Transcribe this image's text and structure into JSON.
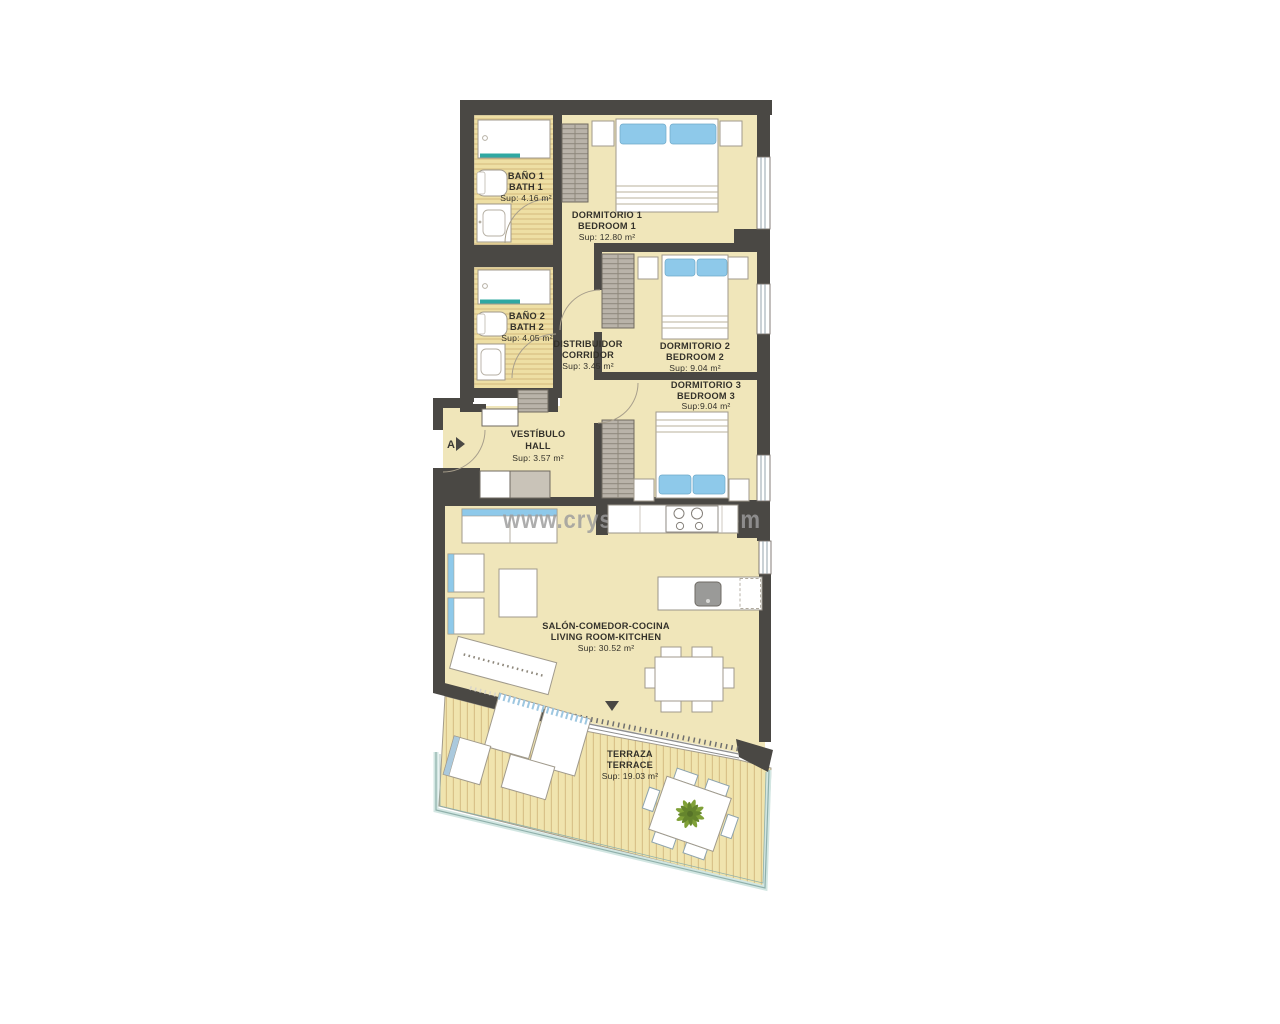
{
  "watermark": "www.crystalshore.com",
  "section_marker": {
    "label": "A"
  },
  "rooms": {
    "bathroom1": {
      "name_es": "BAÑO 1",
      "name_en": "BATH 1",
      "area": "Sup: 4.16 m²"
    },
    "bathroom2": {
      "name_es": "BAÑO 2",
      "name_en": "BATH 2",
      "area": "Sup: 4.05 m²"
    },
    "bedroom1": {
      "name_es": "DORMITORIO 1",
      "name_en": "BEDROOM 1",
      "area": "Sup: 12.80 m²"
    },
    "bedroom2": {
      "name_es": "DORMITORIO 2",
      "name_en": "BEDROOM 2",
      "area": "Sup: 9.04 m²"
    },
    "bedroom3": {
      "name_es": "DORMITORIO 3",
      "name_en": "BEDROOM 3",
      "area": "Sup:9.04 m²"
    },
    "corridor": {
      "name_es": "DISTRIBUIDOR",
      "name_en": "CORRIDOR",
      "area": "Sup: 3.45 m²"
    },
    "hall": {
      "name_es": "VESTÍBULO",
      "name_en": "HALL",
      "area": "Sup: 3.57 m²"
    },
    "living": {
      "name_es": "SALÓN-COMEDOR-COCINA",
      "name_en": "LIVING ROOM-KITCHEN",
      "area": "Sup: 30.52 m²"
    },
    "terrace": {
      "name_es": "TERRAZA",
      "name_en": "TERRACE",
      "area": "Sup: 19.03 m²"
    }
  },
  "colors": {
    "wall": "#4a4844",
    "floor": "#f0e6ba",
    "bath_floor": "#eedfa4",
    "deck_floor": "#f0e4ae",
    "accent_blue": "#8ec9ea",
    "tub_teal": "#2fa8a2",
    "wardrobe_grey": "#b9b3a9",
    "watermark_grey": "#9c9c9c",
    "palm_green": "#7a9c2e"
  }
}
